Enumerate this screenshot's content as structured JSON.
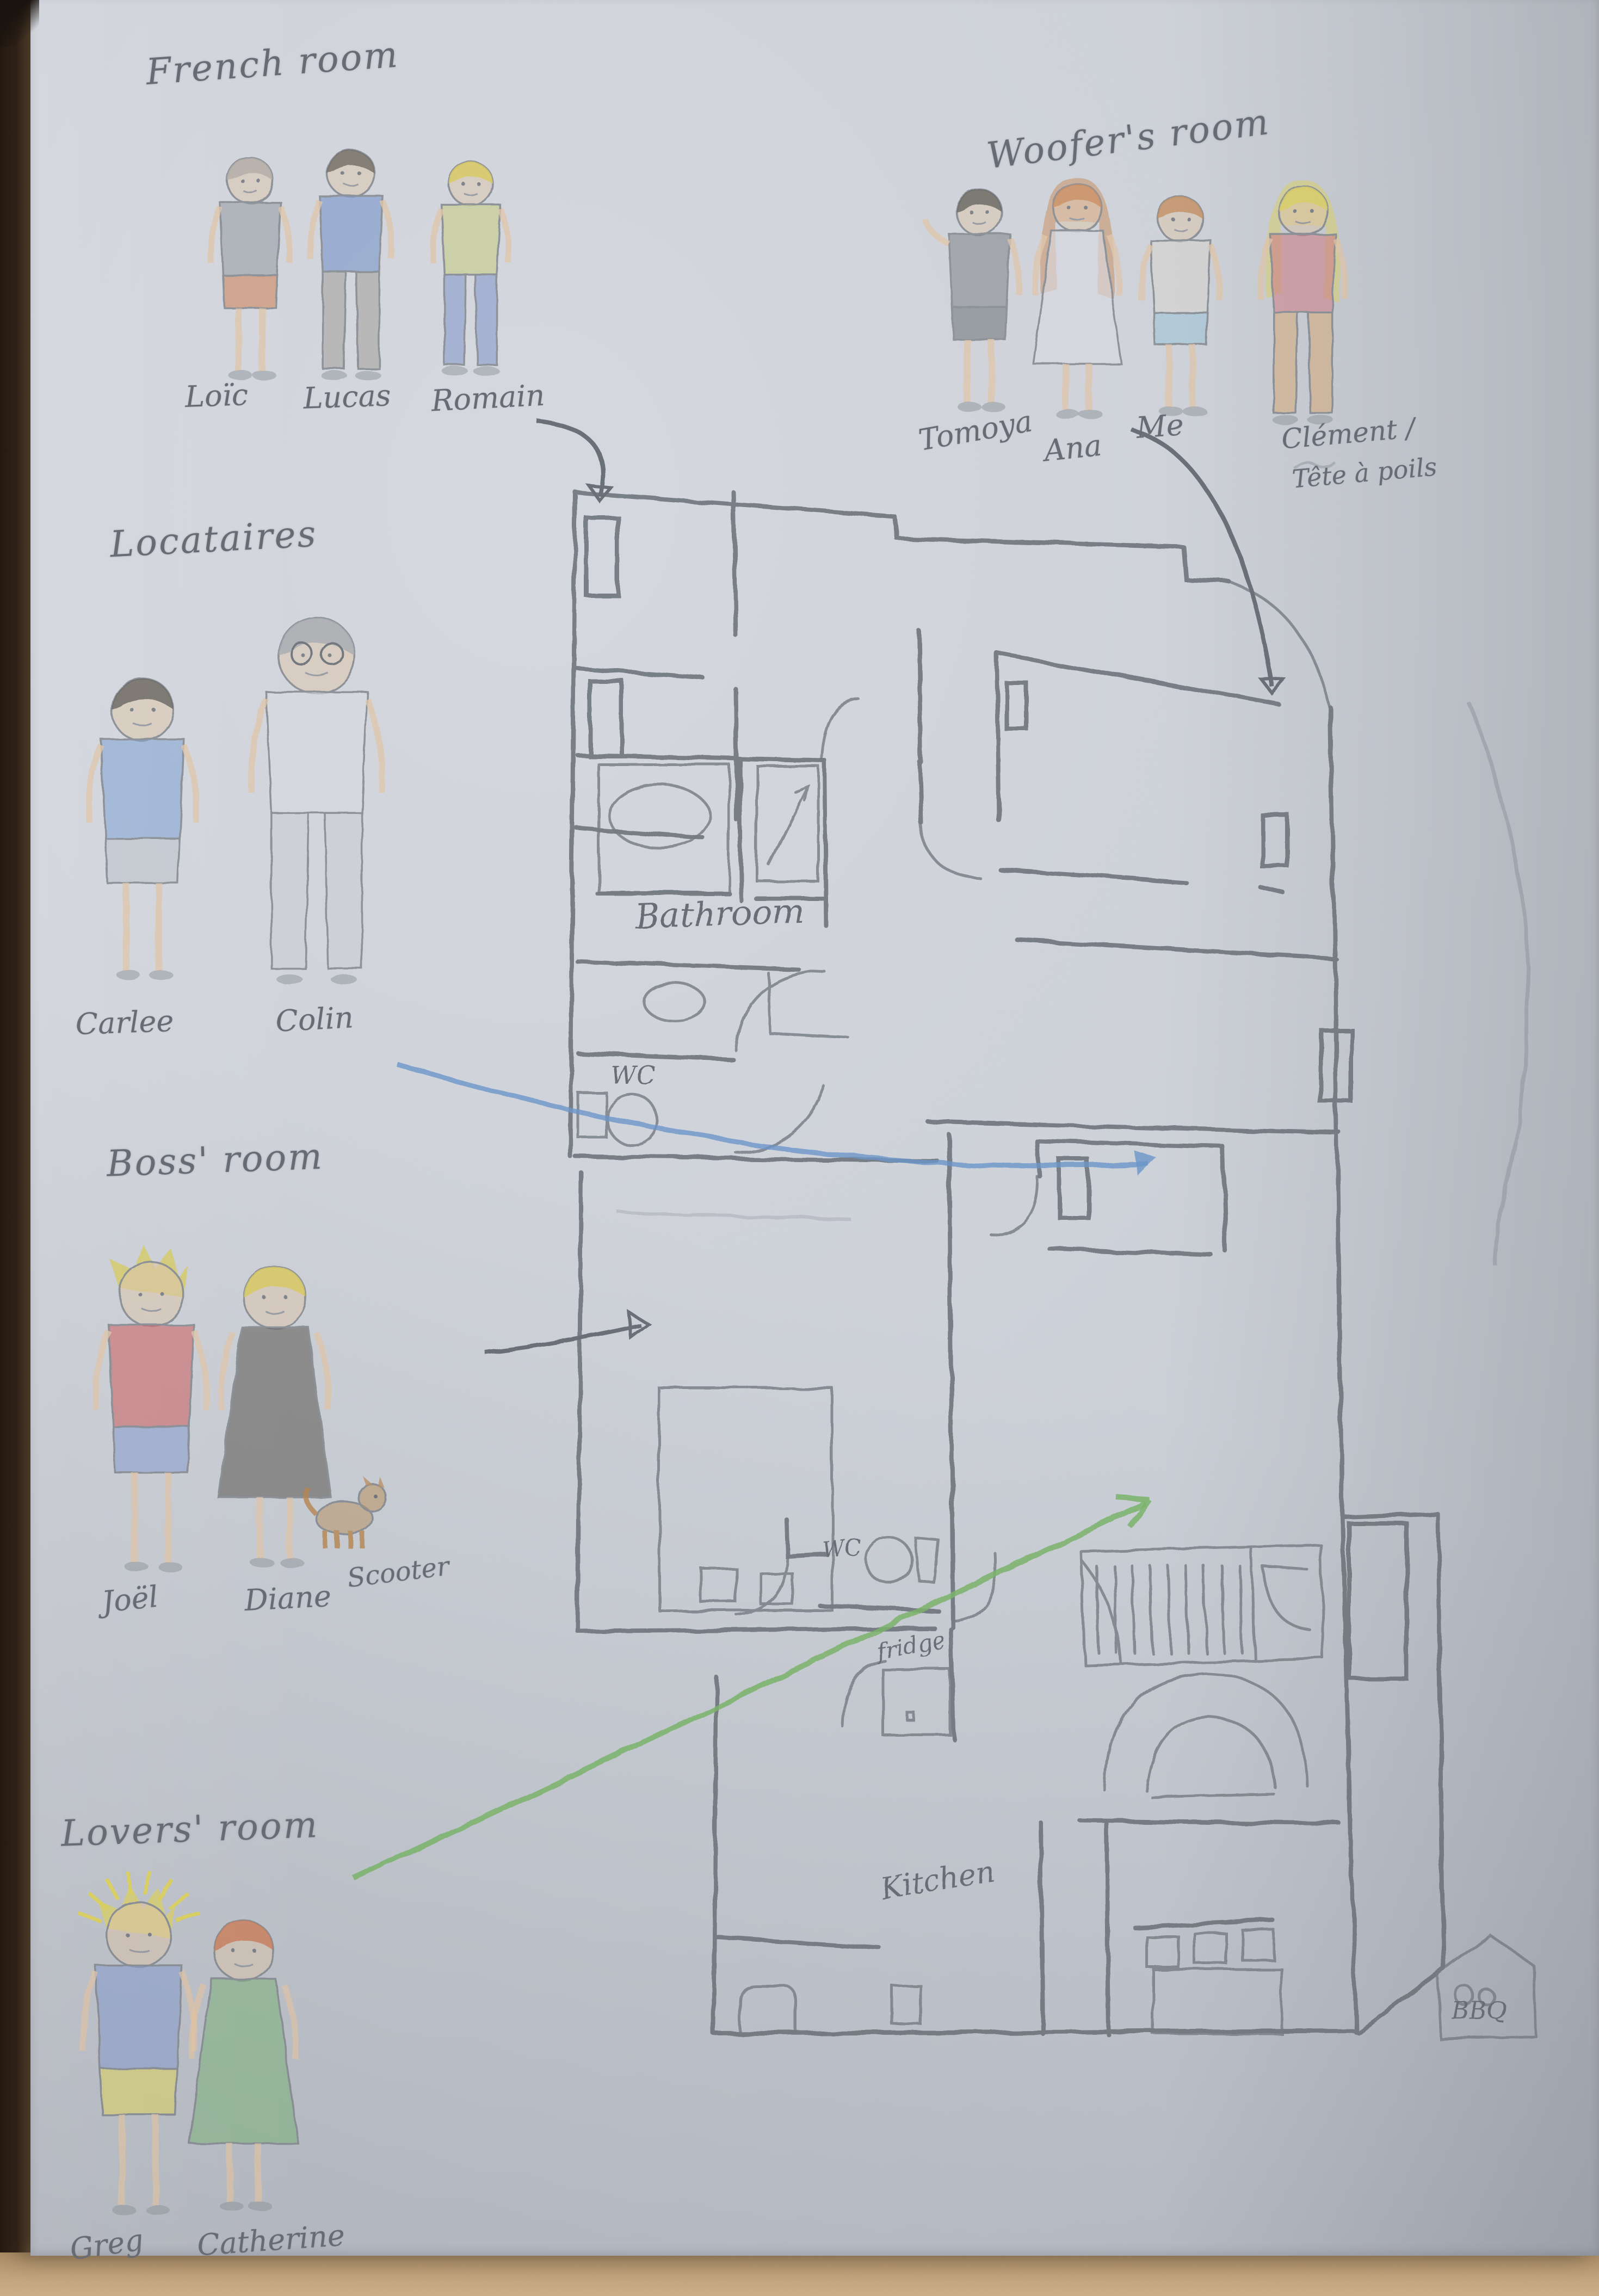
{
  "palette": {
    "paper": "#ccd0d8",
    "pencil_gray": "#6b7077",
    "pencil_blue": "#6b96c9",
    "pencil_green": "#7ab36a",
    "table_wood_dark": "#352416",
    "table_wood_tan": "#c2a47c",
    "skin": "#e2c2a0"
  },
  "groups": [
    {
      "label": "French room",
      "people": [
        {
          "name": "Loïc",
          "hair": "#a9a29a",
          "top": "#8a9097",
          "bottom": "#d0703c",
          "style": "shorts"
        },
        {
          "name": "Lucas",
          "hair": "#564e45",
          "top": "#5d83c4",
          "bottom": "#9b968f",
          "style": "pants"
        },
        {
          "name": "Romain",
          "hair": "#d9c83f",
          "top": "#c3ca6b",
          "bottom": "#7488c8",
          "style": "pants"
        }
      ]
    },
    {
      "label": "Woofer's room",
      "people": [
        {
          "name": "Tomoya",
          "hair": "#4a453e",
          "top": "#71757a",
          "bottom": "#5c6065",
          "style": "shorts",
          "waving": true
        },
        {
          "name": "Ana",
          "hair": "#c97d45",
          "top": "#dcdde2",
          "style": "dress",
          "longhair": true
        },
        {
          "name": "Me",
          "hair": "#c08047",
          "top": "#d9d4cd",
          "bottom": "#92c2d6",
          "style": "shorts"
        },
        {
          "name": "Clément /",
          "alias": "Tête à poils",
          "hair": "#ddd04a",
          "top": "#d16b74",
          "bottom": "#d8a368",
          "style": "pants",
          "longhair": true
        }
      ]
    },
    {
      "label": "Locataires",
      "people": [
        {
          "name": "Carlee",
          "hair": "#4a453e",
          "top": "#6f9ad2",
          "bottom": "#b9bdc4",
          "style": "shorts"
        },
        {
          "name": "Colin",
          "hair": "#9aa0a6",
          "top": "#d8dade",
          "bottom": "#c9ccd2",
          "style": "pants",
          "glasses": true
        }
      ]
    },
    {
      "label": "Boss' room",
      "people": [
        {
          "name": "Joël",
          "hair": "#d9c83f",
          "top": "#cc4b4b",
          "bottom": "#7b93cf",
          "style": "shorts",
          "spiky": true
        },
        {
          "name": "Diane",
          "hair": "#d9c83f",
          "top": "#433f3c",
          "bottom": "#d16b74",
          "style": "dress"
        },
        {
          "name": "Scooter",
          "type": "dog",
          "color": "#b5854f"
        }
      ]
    },
    {
      "label": "Lovers' room",
      "people": [
        {
          "name": "Greg",
          "hair": "#e0d34a",
          "top": "#7b93cf",
          "bottom": "#e3d44b",
          "style": "shorts",
          "spiky": true,
          "rays": true
        },
        {
          "name": "Catherine",
          "hair": "#cc6b3d",
          "top": "#6fae6a",
          "style": "dress"
        }
      ]
    }
  ],
  "floorplan": {
    "rooms": [
      {
        "label": "Bathroom"
      },
      {
        "label": "WC"
      },
      {
        "label": "WC"
      },
      {
        "label": "fridge"
      },
      {
        "label": "Kitchen"
      },
      {
        "label": "BBQ"
      }
    ]
  }
}
